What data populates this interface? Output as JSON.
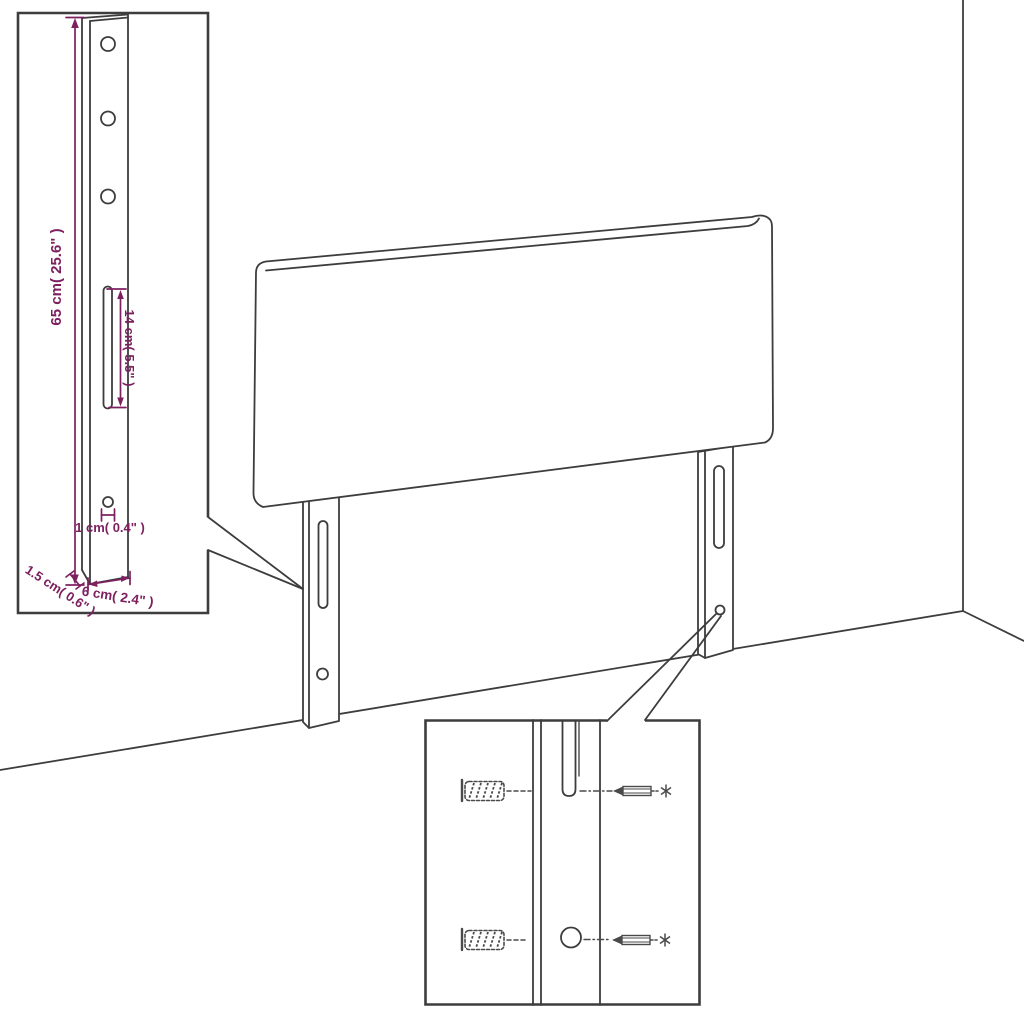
{
  "labels": {
    "leg_height": "65 cm( 25.6\" )",
    "slot_length": "14 cm( 5.5\" )",
    "hole_diameter": "1 cm( 0.4\" )",
    "leg_thickness": "1.5 cm( 0.6\" )",
    "leg_width": "6 cm( 2.4\" )"
  },
  "colors": {
    "line": "#3d3d3d",
    "dimension": "#7d2060",
    "background": "#ffffff"
  }
}
